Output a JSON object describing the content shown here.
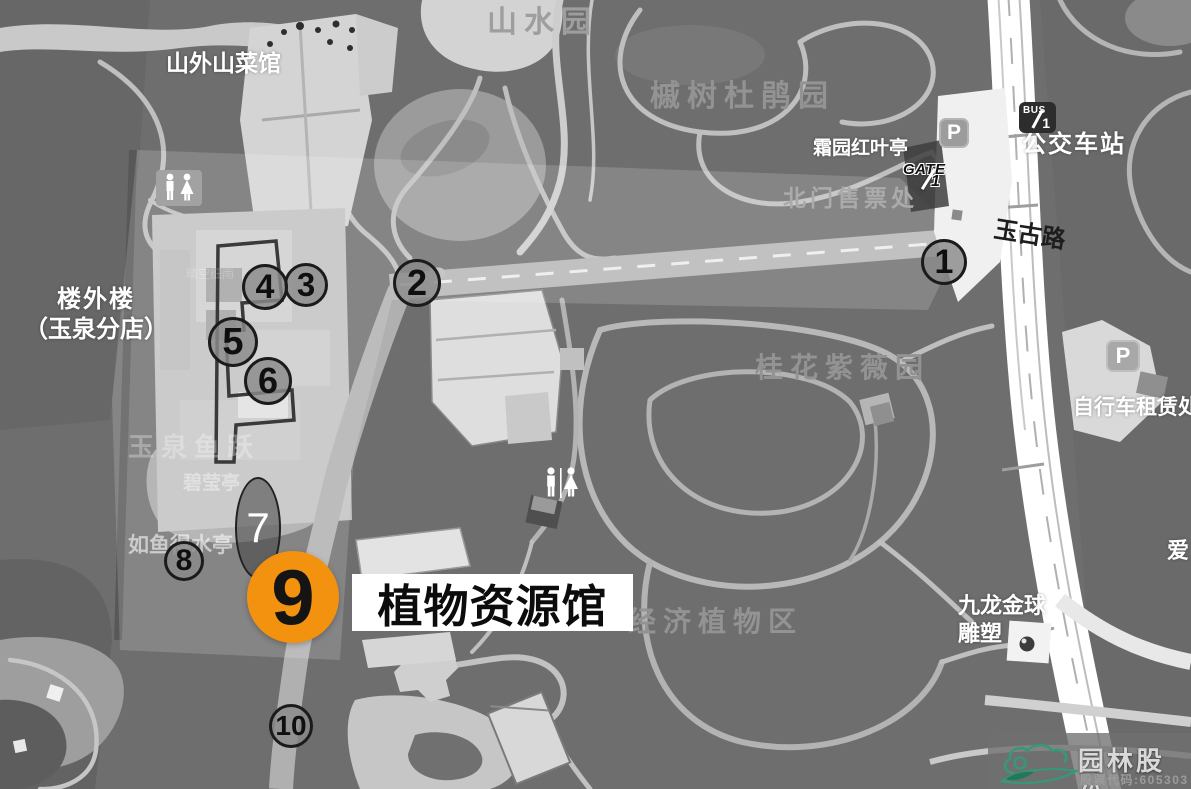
{
  "colors": {
    "accent_orange": "#F2920F",
    "marker_gray": "#8A8A8A",
    "logo_green": "#35987A",
    "map_background": "#6E6E6E"
  },
  "regions": {
    "shanshui_garden": "山水园",
    "maple_azalea_garden": "槭树杜鹃园",
    "osmanthus_crape_myrtle_garden": "桂花紫薇园",
    "economic_plants_area": "经济植物区"
  },
  "places": {
    "shanwaishan_restaurant": "山外山菜馆",
    "shuangyuan_redleaf_pavilion": "霜园红叶亭",
    "north_gate_ticket_office": "北门售票处",
    "bus_station": "公交车站",
    "yugu_road": "玉古路",
    "louwailou_line1": "楼外楼",
    "louwailou_line2": "（玉泉分店）",
    "bicycle_rental": "自行车租赁处",
    "yuquan_fish_leap": "玉泉鱼跃",
    "biying_pavilion": "碧莹亭",
    "ruyudeshui_pavilion": "如鱼得水亭",
    "nine_dragon_golden_ball_line1": "九龙金球",
    "nine_dragon_golden_ball_line2": "雕塑",
    "love_label_partial": "爱",
    "faint_pool_label": "晴空细雨"
  },
  "badges": {
    "gate_text": "GATE",
    "gate_number": "1",
    "bus_text": "BUS",
    "bus_number": "1",
    "parking_letter": "P"
  },
  "markers": [
    {
      "label": "1"
    },
    {
      "label": "2"
    },
    {
      "label": "3"
    },
    {
      "label": "4"
    },
    {
      "label": "5"
    },
    {
      "label": "6"
    },
    {
      "label": "7"
    },
    {
      "label": "8"
    },
    {
      "label": "10"
    }
  ],
  "callout": {
    "number": "9",
    "label": "植物资源馆"
  },
  "watermark": {
    "company": "园林股份",
    "stock_code": "股票代码:605303"
  }
}
